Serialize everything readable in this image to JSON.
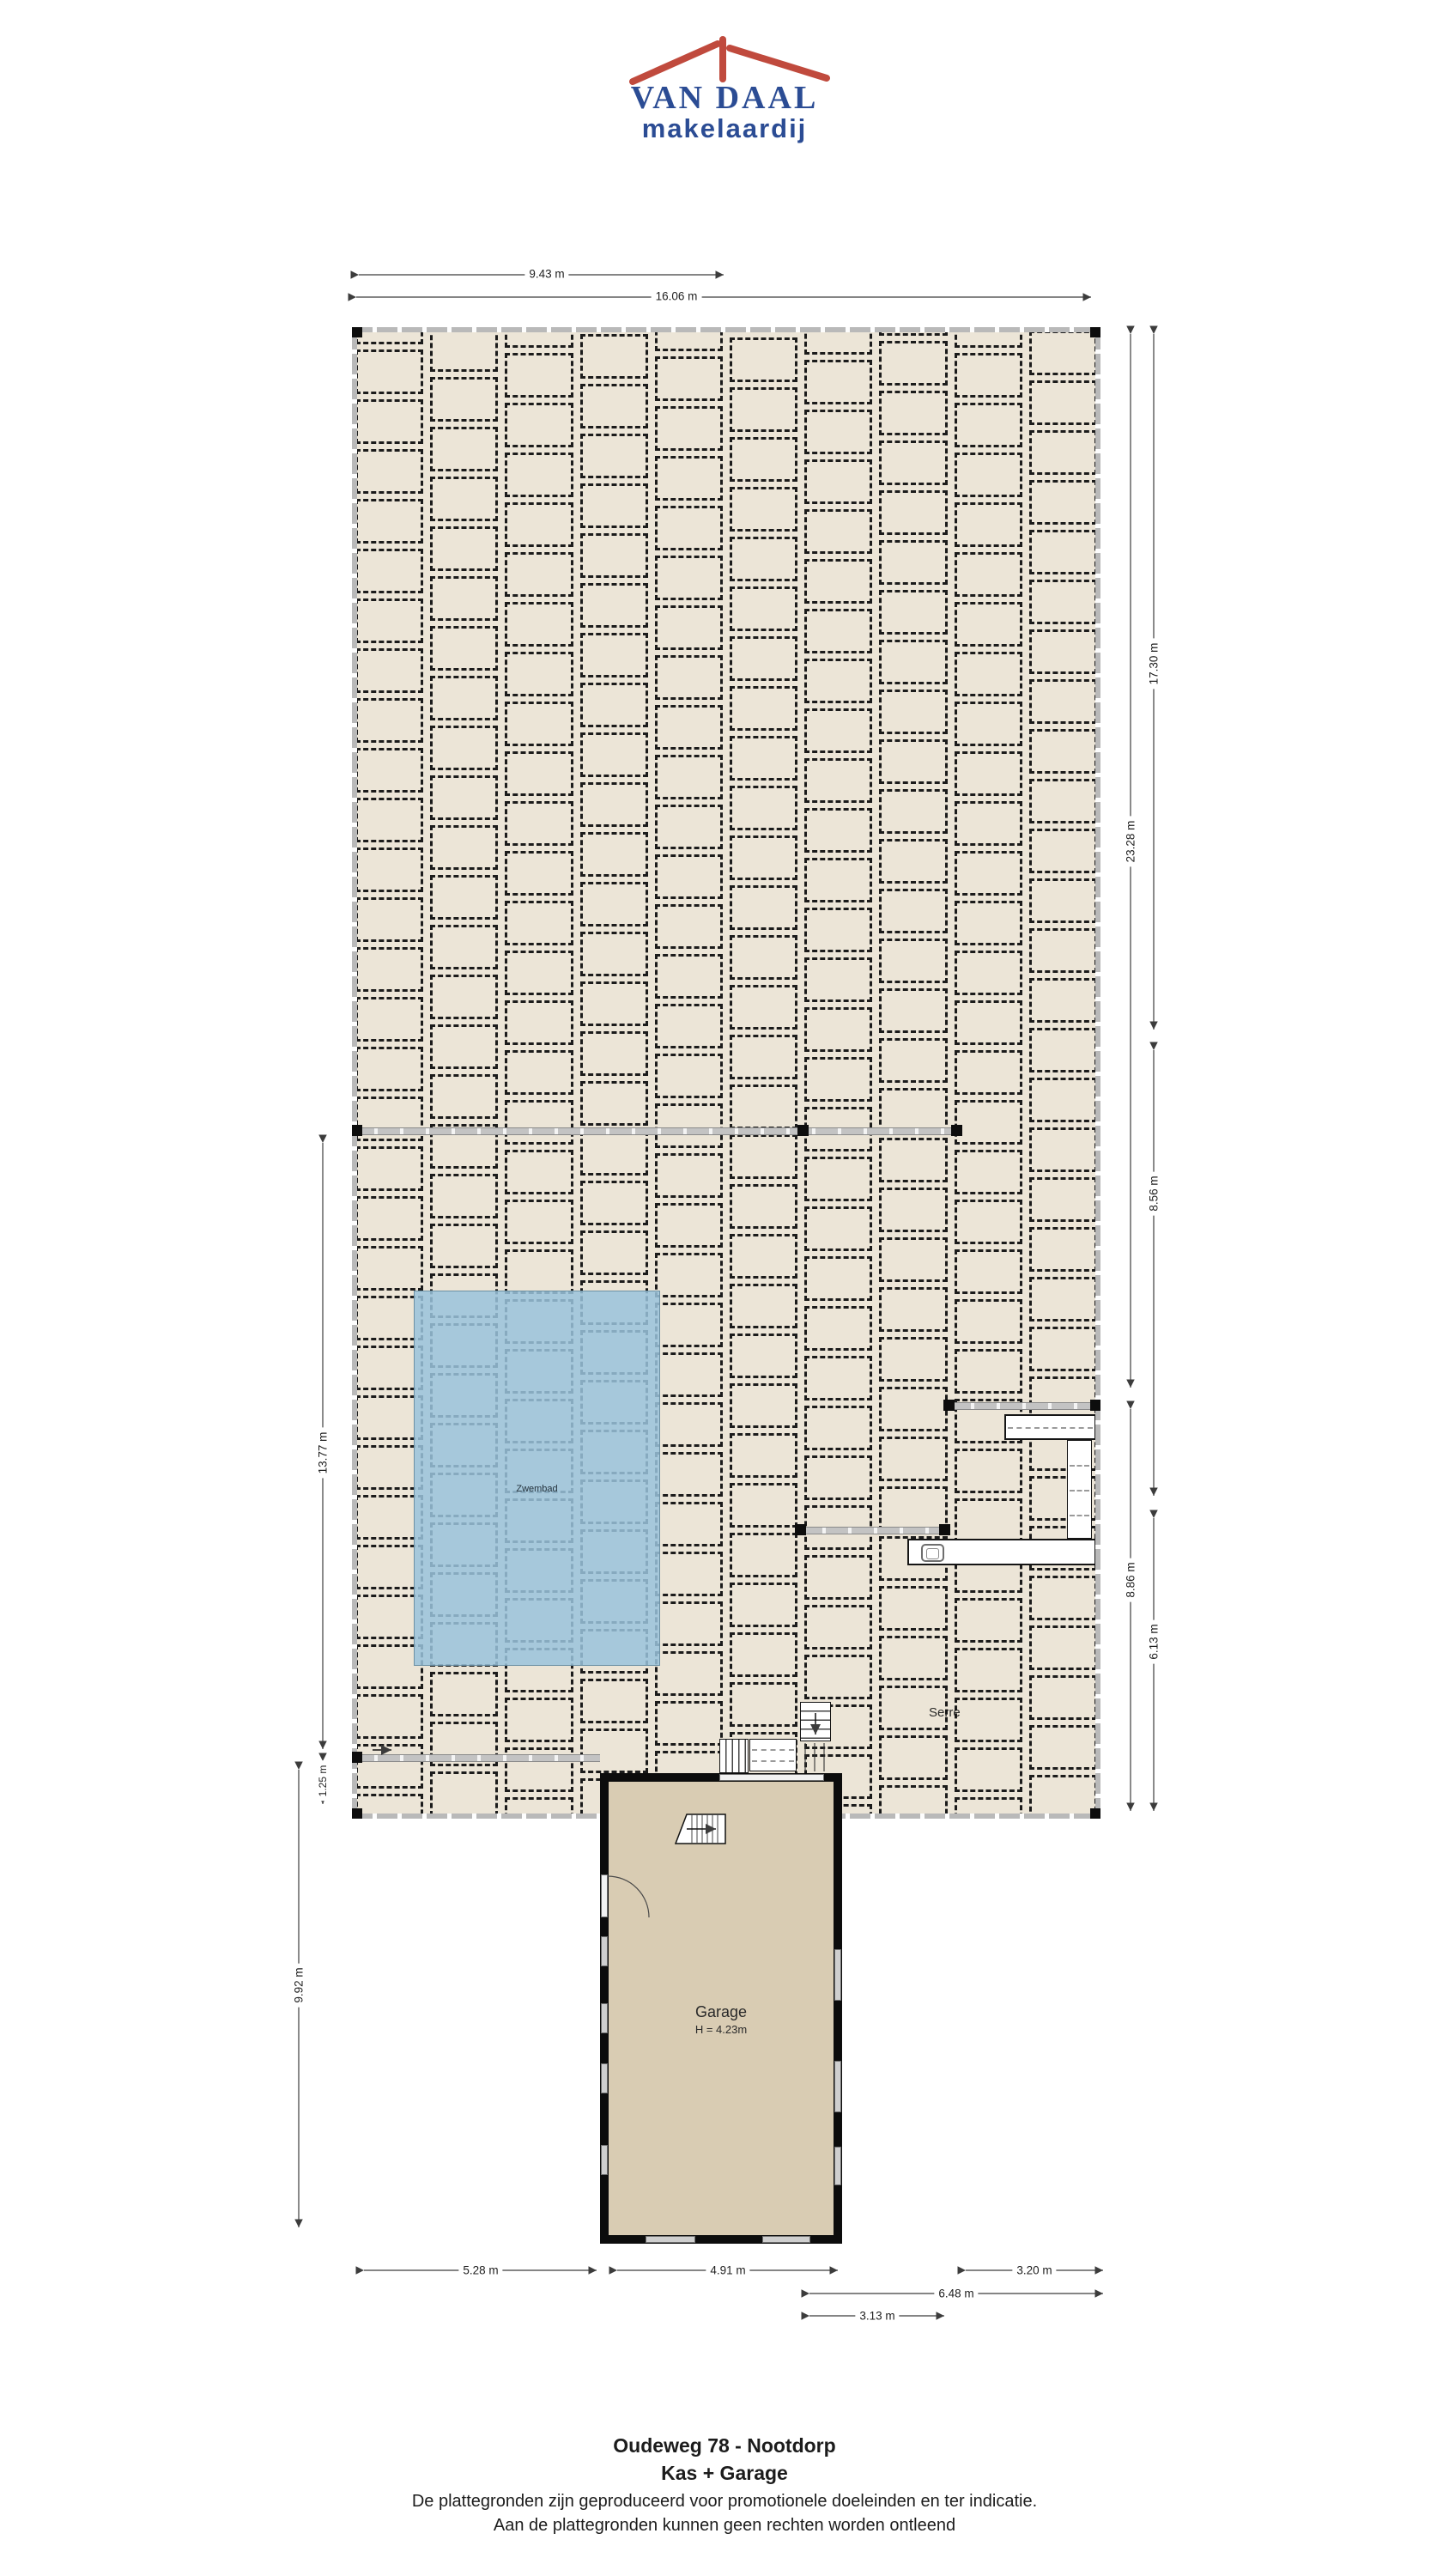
{
  "logo": {
    "name": "VAN DAAL",
    "tagline": "makelaardij",
    "blue": "#2b4c94",
    "red": "#c04a3d"
  },
  "labels": {
    "pool": "Zwembad",
    "serre": "Serre",
    "garage": "Garage",
    "garage_height": "H = 4.23m"
  },
  "dims": {
    "top": [
      "9.43 m",
      "16.06 m"
    ],
    "right": [
      "17.30 m",
      "23.28 m",
      "8.56 m",
      "8.86 m",
      "6.13 m"
    ],
    "left": [
      "13.77 m",
      "1.25 m",
      "9.92 m"
    ],
    "bottom": [
      "5.28 m",
      "4.91 m",
      "3.20 m",
      "6.48 m",
      "3.13 m"
    ]
  },
  "footer": {
    "title": "Oudeweg 78 - Nootdorp",
    "subtitle": "Kas + Garage",
    "disclaimer1": "De plattegronden zijn geproduceerd voor promotionele doeleinden en ter indicatie.",
    "disclaimer2": "Aan de plattegronden kunnen geen rechten worden ontleend"
  },
  "colors": {
    "cell_fill": "#ece5d7",
    "pool_fill": "#a9c7d9",
    "garage_fill": "#d9ccb3",
    "wall": "#0d0d0d"
  }
}
